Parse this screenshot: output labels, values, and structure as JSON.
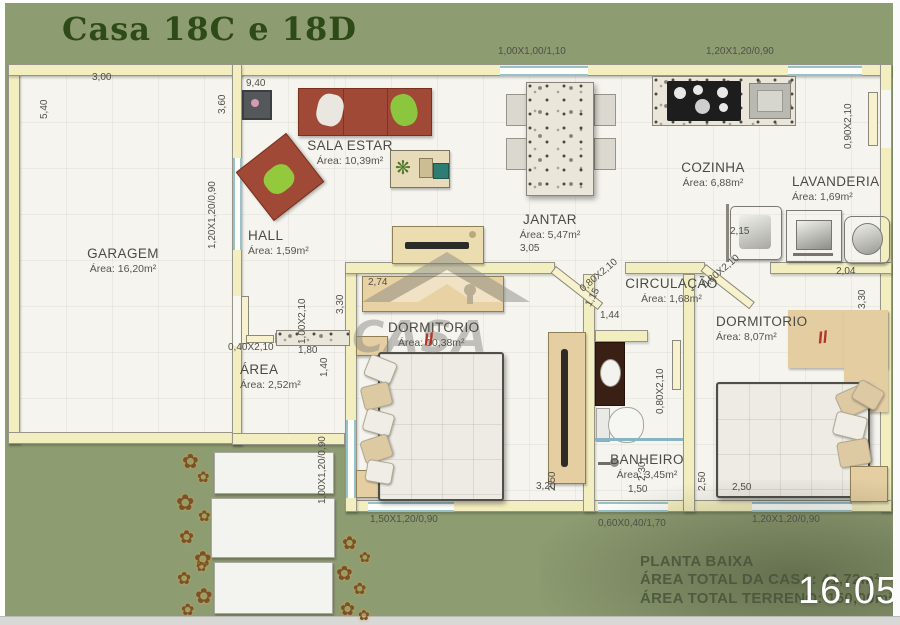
{
  "title": "Casa 18C e 18D",
  "clock": "16:05",
  "watermark": "CASA",
  "brand_mark": "Il",
  "footer": {
    "line1": "PLANTA BAIXA",
    "line2": "ÁREA TOTAL DA CASA: 41,72m²",
    "line3": "ÁREA TOTAL TERRENO: 150,00m²"
  },
  "rooms": {
    "garagem": {
      "name": "GARAGEM",
      "area": "Área: 16,20m²"
    },
    "sala": {
      "name": "SALA ESTAR",
      "area": "Área: 10,39m²"
    },
    "hall": {
      "name": "HALL",
      "area": "Área: 1,59m²"
    },
    "jantar": {
      "name": "JANTAR",
      "area": "Área: 5,47m²"
    },
    "cozinha": {
      "name": "COZINHA",
      "area": "Área: 6,88m²"
    },
    "lavanderia": {
      "name": "LAVANDERIA",
      "area": "Área: 1,69m²"
    },
    "circulacao": {
      "name": "CIRCULAÇÃO",
      "area": "Área: 1,68m²"
    },
    "dormitorio1": {
      "name": "DORMITORIO",
      "area": "Área: 10,38m²"
    },
    "banheiro": {
      "name": "BANHEIRO",
      "area": "Área: 3,45m²"
    },
    "dormitorio2": {
      "name": "DORMITORIO",
      "area": "Área: 8,07m²"
    },
    "area_servico": {
      "name": "ÁREA",
      "area": "Área: 2,52m²"
    }
  },
  "dimension_labels": [
    "3,00",
    "5,40",
    "9,40",
    "3,60",
    "1,00X1,00/1,10",
    "1,20X1,20/0,90",
    "0,90X2,10",
    "1,20X1,20/0,90",
    "3,05",
    "2,74",
    "3,30",
    "0,80X2,10",
    "1,15",
    "1,44",
    "0,80X2,10",
    "2,04",
    "3,30",
    "2,15",
    "1,00X2,10",
    "0,40X2,10",
    "1,80",
    "1,40",
    "0,80X2,10",
    "3,20",
    "2,50",
    "1,50",
    "2,30",
    "2,50",
    "2,50",
    "1,00X1,20/0,90",
    "1,50X1,20/0,90",
    "0,60X0,40/1,70",
    "1,20X1,20/0,90"
  ],
  "icons": {
    "flower": "✿",
    "plant": "❋"
  },
  "colors": {
    "olive": "#8e9c72",
    "wall_fill": "#f3eec0",
    "window_blue": "#98c2c9",
    "furniture_red": "#a04936",
    "title_green": "#2d4a17"
  }
}
